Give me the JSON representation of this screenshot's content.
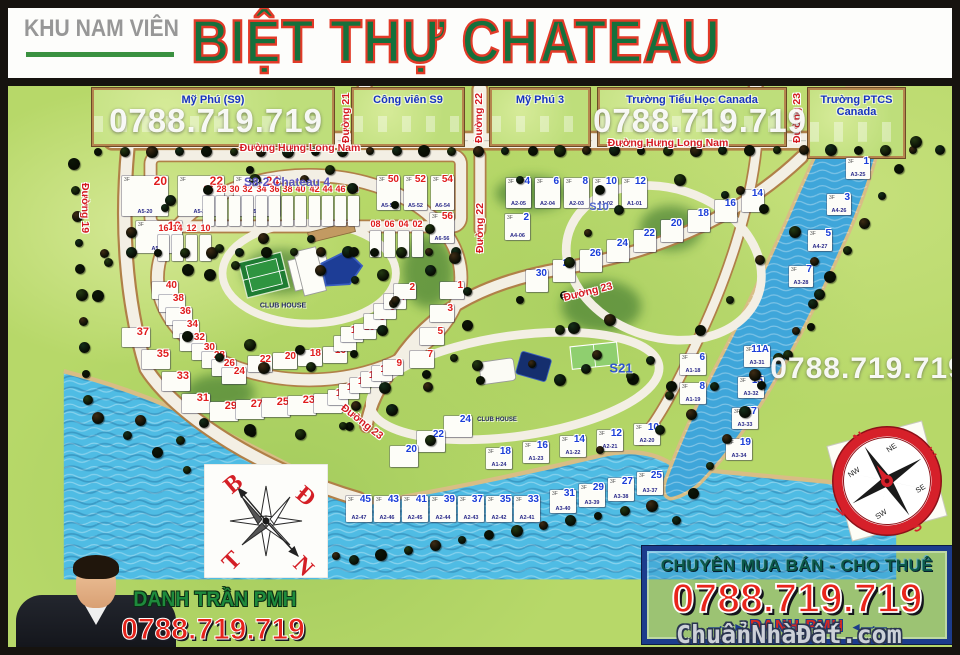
{
  "header": {
    "area_label": "KHU NAM VIÊN",
    "title": "BIỆT THỰ CHATEAU"
  },
  "colors": {
    "title_green": "#15703c",
    "title_outline_red": "#e23a28",
    "phone_red": "#e4231b",
    "district_label_blue": "#1733c0",
    "street_label_red": "#d41a22",
    "water": "#4fbce4",
    "river": "#3fa6da",
    "grass": "#b7d869",
    "road": "#f3efe4",
    "promo_border_blue": "#1c3c8c",
    "promo_tagline_green": "#0c5a49",
    "agent_name_green": "#1e8a3c",
    "lot_red": "#e01c1c",
    "lot_blue": "#1b3ed8"
  },
  "map": {
    "districts": [
      {
        "label": "Mỹ Phú (S9)",
        "x": 92,
        "y": 88,
        "w": 242,
        "h": 58
      },
      {
        "label": "Công viên S9",
        "x": 352,
        "y": 88,
        "w": 112,
        "h": 58
      },
      {
        "label": "Mỹ Phú 3",
        "x": 490,
        "y": 88,
        "w": 100,
        "h": 58
      },
      {
        "label": "Trường Tiểu Học Canada",
        "x": 598,
        "y": 88,
        "w": 188,
        "h": 58
      },
      {
        "label": "Trường PTCS Canada",
        "x": 808,
        "y": 88,
        "w": 97,
        "h": 70
      }
    ],
    "street_labels": [
      {
        "text": "Đường 21",
        "x": 346,
        "y": 118,
        "rot": -90
      },
      {
        "text": "Đường 22",
        "x": 479,
        "y": 118,
        "rot": -90
      },
      {
        "text": "Đường 23",
        "x": 797,
        "y": 118,
        "rot": -90
      },
      {
        "text": "Đường Hưng Long Nam",
        "x": 300,
        "y": 148,
        "rot": 0
      },
      {
        "text": "Đường Hưng Long Nam",
        "x": 668,
        "y": 143,
        "rot": 0
      },
      {
        "text": "Đường 19",
        "x": 85,
        "y": 208,
        "rot": 90
      },
      {
        "text": "Đường 22",
        "x": 480,
        "y": 228,
        "rot": -90
      },
      {
        "text": "Đường 23",
        "x": 588,
        "y": 292,
        "rot": -14
      },
      {
        "text": "Đường 23",
        "x": 362,
        "y": 422,
        "rot": 38
      }
    ],
    "phone_overlays": [
      {
        "text": "0788.719.719",
        "x": 216,
        "y": 121,
        "size": 33
      },
      {
        "text": "0788.719.719",
        "x": 700,
        "y": 121,
        "size": 33
      },
      {
        "text": "0788.719.719",
        "x": 868,
        "y": 369,
        "size": 30
      }
    ],
    "section_labels": [
      {
        "text": "S8-2 Chateau 4",
        "x": 287,
        "y": 182,
        "size": 12,
        "color": "#5b55c0"
      },
      {
        "text": "S10",
        "x": 599,
        "y": 207,
        "size": 11,
        "color": "#4f66cc"
      },
      {
        "text": "S21",
        "x": 621,
        "y": 368,
        "size": 13,
        "color": "#2f55cc"
      },
      {
        "text": "CLUB HOUSE",
        "x": 283,
        "y": 306,
        "size": 7,
        "color": "#21285e"
      },
      {
        "text": "CLUB HOUSE",
        "x": 497,
        "y": 420,
        "size": 6,
        "color": "#21285e"
      }
    ],
    "lot_floor_label": "3F",
    "lot_sections": [
      {
        "c": "red",
        "x": 122,
        "y": 176,
        "dx": 56,
        "dy": 0,
        "w": 46,
        "h": 40,
        "fs": 12,
        "n": [
          "20",
          "22",
          "24"
        ],
        "codes": [
          "A5-20",
          "A5-22",
          "A5-24"
        ]
      },
      {
        "c": "red",
        "x": 136,
        "y": 221,
        "dx": 0,
        "dy": 0,
        "w": 46,
        "h": 32,
        "fs": 12,
        "n": [
          "18"
        ],
        "codes": [
          "A5-18"
        ]
      },
      {
        "c": "red",
        "x": 203,
        "y": 196,
        "dx": 13,
        "dy": 0,
        "w": 11,
        "h": 30,
        "fs": 9,
        "n": [
          "26",
          "28",
          "30",
          "32"
        ]
      },
      {
        "c": "red",
        "x": 256,
        "y": 196,
        "dx": 13,
        "dy": 0,
        "w": 11,
        "h": 30,
        "fs": 9,
        "n": [
          "34",
          "36",
          "38",
          "40"
        ]
      },
      {
        "c": "red",
        "x": 309,
        "y": 196,
        "dx": 13,
        "dy": 0,
        "w": 11,
        "h": 30,
        "fs": 9,
        "n": [
          "42",
          "44",
          "46",
          "48"
        ]
      },
      {
        "c": "red",
        "x": 377,
        "y": 176,
        "dx": 27,
        "dy": 0,
        "w": 23,
        "h": 34,
        "fs": 10,
        "n": [
          "50",
          "52",
          "54"
        ],
        "codes": [
          "A5-50",
          "A5-52",
          "A6-54"
        ]
      },
      {
        "c": "red",
        "x": 430,
        "y": 213,
        "dx": 0,
        "dy": 0,
        "w": 24,
        "h": 30,
        "fs": 10,
        "n": [
          "56"
        ],
        "codes": [
          "A6-56"
        ]
      },
      {
        "c": "red",
        "x": 158,
        "y": 235,
        "dx": 14,
        "dy": 0,
        "w": 11,
        "h": 26,
        "fs": 9,
        "n": [
          "16",
          "14",
          "12",
          "10"
        ]
      },
      {
        "c": "red",
        "x": 370,
        "y": 231,
        "dx": 14,
        "dy": 0,
        "w": 11,
        "h": 26,
        "fs": 9,
        "n": [
          "08",
          "06",
          "04",
          "02"
        ]
      },
      {
        "c": "red",
        "x": 152,
        "y": 282,
        "dx": 7,
        "dy": 13,
        "w": 26,
        "h": 17,
        "fs": 10,
        "n": [
          "40",
          "38",
          "36",
          "34",
          "32"
        ]
      },
      {
        "c": "red",
        "x": 192,
        "y": 344,
        "dx": 10,
        "dy": 8,
        "w": 24,
        "h": 16,
        "fs": 10,
        "n": [
          "30",
          "28",
          "26",
          "24"
        ]
      },
      {
        "c": "red",
        "x": 248,
        "y": 356,
        "dx": 25,
        "dy": -3,
        "w": 24,
        "h": 16,
        "fs": 10,
        "n": [
          "22",
          "20",
          "18",
          "16"
        ]
      },
      {
        "c": "red",
        "x": 334,
        "y": 336,
        "dx": 7,
        "dy": -9,
        "w": 22,
        "h": 15,
        "fs": 10,
        "n": [
          "14",
          "12"
        ]
      },
      {
        "c": "red",
        "x": 354,
        "y": 324,
        "dx": 10,
        "dy": -10,
        "w": 22,
        "h": 15,
        "fs": 10,
        "n": [
          "10",
          "8",
          "6",
          "4",
          "2"
        ]
      },
      {
        "c": "red",
        "x": 122,
        "y": 328,
        "dx": 20,
        "dy": 22,
        "w": 28,
        "h": 19,
        "fs": 11,
        "n": [
          "37",
          "35",
          "33",
          "31"
        ]
      },
      {
        "c": "red",
        "x": 210,
        "y": 402,
        "dx": 26,
        "dy": -2,
        "w": 28,
        "h": 19,
        "fs": 11,
        "n": [
          "29",
          "27",
          "25",
          "23",
          "21"
        ]
      },
      {
        "c": "red",
        "x": 328,
        "y": 390,
        "dx": 11,
        "dy": -6,
        "w": 20,
        "h": 15,
        "fs": 10,
        "n": [
          "19",
          "17",
          "15",
          "13",
          "11",
          "9"
        ]
      },
      {
        "c": "red",
        "x": 440,
        "y": 282,
        "dx": -10,
        "dy": 23,
        "w": 24,
        "h": 17,
        "fs": 10,
        "n": [
          "1",
          "3",
          "5",
          "7"
        ]
      },
      {
        "c": "blue",
        "x": 506,
        "y": 178,
        "dx": 29,
        "dy": 0,
        "w": 25,
        "h": 30,
        "fs": 10,
        "n": [
          "4",
          "6",
          "8",
          "10",
          "12"
        ],
        "codes": [
          "A2-05",
          "A2-04",
          "A2-03",
          "A1-02",
          "A1-01"
        ]
      },
      {
        "c": "blue",
        "x": 505,
        "y": 214,
        "dx": 0,
        "dy": 0,
        "w": 25,
        "h": 26,
        "fs": 10,
        "n": [
          "2"
        ],
        "codes": [
          "A4-06"
        ]
      },
      {
        "c": "blue",
        "x": 742,
        "y": 190,
        "dx": -27,
        "dy": 10,
        "w": 22,
        "h": 22,
        "fs": 10,
        "n": [
          "14",
          "16",
          "18",
          "20",
          "22",
          "24",
          "26",
          "28",
          "30"
        ]
      },
      {
        "c": "blue",
        "x": 846,
        "y": 158,
        "dx": -19,
        "dy": 36,
        "w": 24,
        "h": 21,
        "fs": 10,
        "n": [
          "1",
          "3",
          "5",
          "7"
        ],
        "codes": [
          "A3-25",
          "A4-26",
          "A4-27",
          "A3-28"
        ]
      },
      {
        "c": "blue",
        "x": 680,
        "y": 354,
        "dx": 0,
        "dy": 29,
        "w": 26,
        "h": 21,
        "fs": 10,
        "n": [
          "6",
          "8"
        ],
        "codes": [
          "A1-18",
          "A1-19"
        ]
      },
      {
        "c": "blue",
        "x": 744,
        "y": 346,
        "dx": -6,
        "dy": 31,
        "w": 26,
        "h": 21,
        "fs": 10,
        "n": [
          "11A",
          "15",
          "17",
          "19"
        ],
        "codes": [
          "A3-31",
          "A3-32",
          "A3-33",
          "A3-34"
        ]
      },
      {
        "c": "blue",
        "x": 444,
        "y": 416,
        "dx": -27,
        "dy": 15,
        "w": 28,
        "h": 21,
        "fs": 10,
        "n": [
          "24",
          "22",
          "20"
        ]
      },
      {
        "c": "blue",
        "x": 486,
        "y": 448,
        "dx": 37,
        "dy": -6,
        "w": 26,
        "h": 21,
        "fs": 10,
        "n": [
          "18",
          "16",
          "14",
          "12",
          "10"
        ],
        "codes": [
          "A1-24",
          "A1-23",
          "A1-22",
          "A2-21",
          "A2-20"
        ]
      },
      {
        "c": "blue",
        "x": 346,
        "y": 496,
        "dx": 28,
        "dy": 0,
        "w": 26,
        "h": 26,
        "fs": 10,
        "n": [
          "45",
          "43",
          "41",
          "39",
          "37",
          "35",
          "33"
        ],
        "codes": [
          "A2-47",
          "A2-46",
          "A2-45",
          "A2-44",
          "A2-43",
          "A2-42",
          "A2-41"
        ]
      },
      {
        "c": "blue",
        "x": 550,
        "y": 490,
        "dx": 29,
        "dy": -6,
        "w": 26,
        "h": 23,
        "fs": 10,
        "n": [
          "31",
          "29",
          "27",
          "25"
        ],
        "codes": [
          "A3-40",
          "A3-39",
          "A3-38",
          "A3-37"
        ]
      }
    ]
  },
  "compass_sketch": {
    "north": "B",
    "east": "Đ",
    "west": "T",
    "south": "N"
  },
  "compass_rose": {
    "n": "N",
    "e": "E",
    "s": "S",
    "w": "W",
    "ne": "NE",
    "se": "SE",
    "sw": "SW",
    "nw": "NW"
  },
  "agent": {
    "name": "DANH TRẦN PMH",
    "phone": "0788.719.719"
  },
  "promo": {
    "tagline": "CHUYÊN MUA BÁN - CHO THUÊ",
    "phone": "0788.719.719",
    "name": "DANH PMH",
    "arrow_left": "—·—►",
    "arrow_right": "◄—·—"
  },
  "watermark": "ChuẩnNhàĐất.com"
}
